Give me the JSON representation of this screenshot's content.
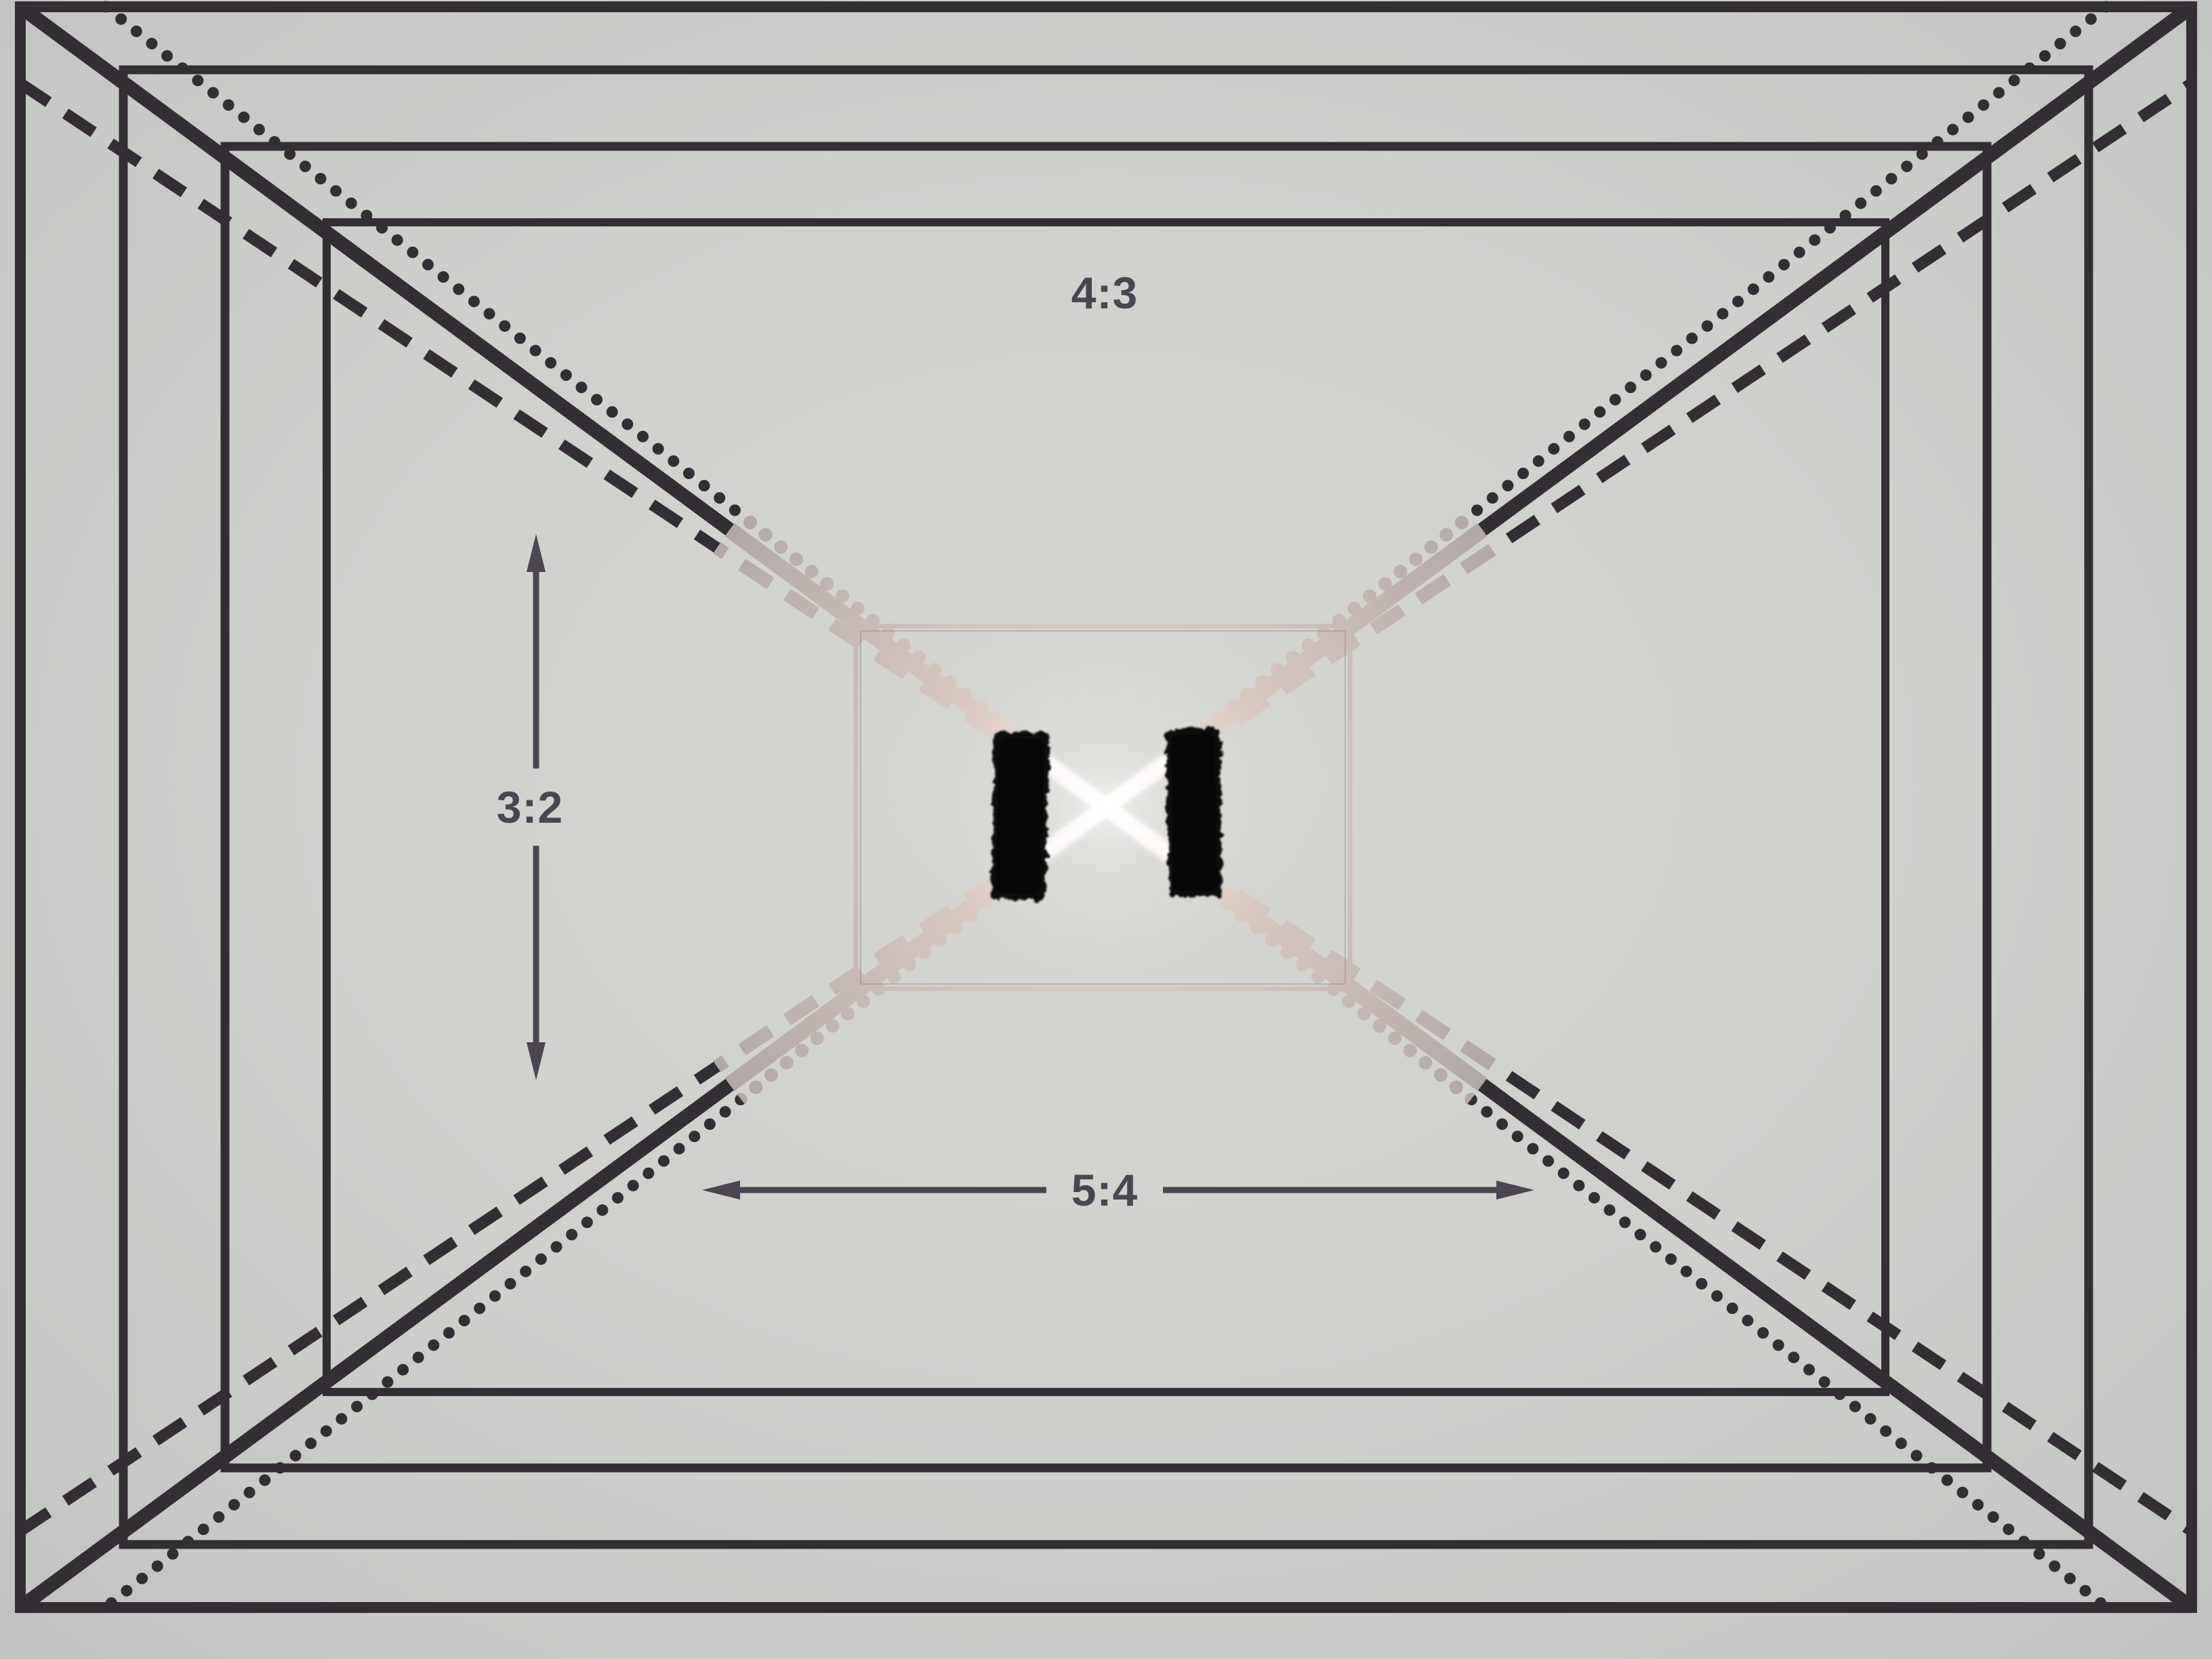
{
  "diagram": {
    "labels": {
      "top_ratio": "4:3",
      "left_ratio": "3:2",
      "bottom_ratio": "5:4"
    },
    "colors": {
      "paper": "#ced0cc",
      "ink": "#332e33",
      "annotation_ink": "#4b4550",
      "metallic_tape": "#d2c7c0",
      "velcro": "#0a0a0b"
    }
  }
}
